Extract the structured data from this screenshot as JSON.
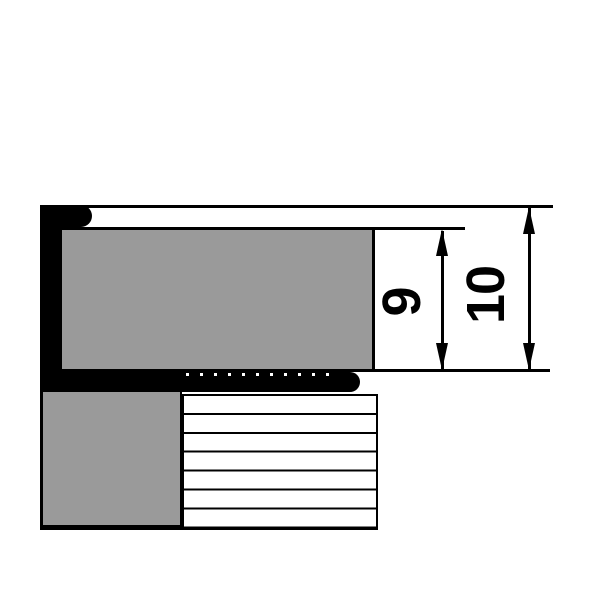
{
  "drawing": {
    "type": "technical-cross-section",
    "dimensions": [
      {
        "id": "dim-9",
        "label": "9"
      },
      {
        "id": "dim-10",
        "label": "10"
      }
    ],
    "colors": {
      "line_black": "#000000",
      "fill_gray": "#9a9a9a",
      "background": "#ffffff"
    }
  }
}
